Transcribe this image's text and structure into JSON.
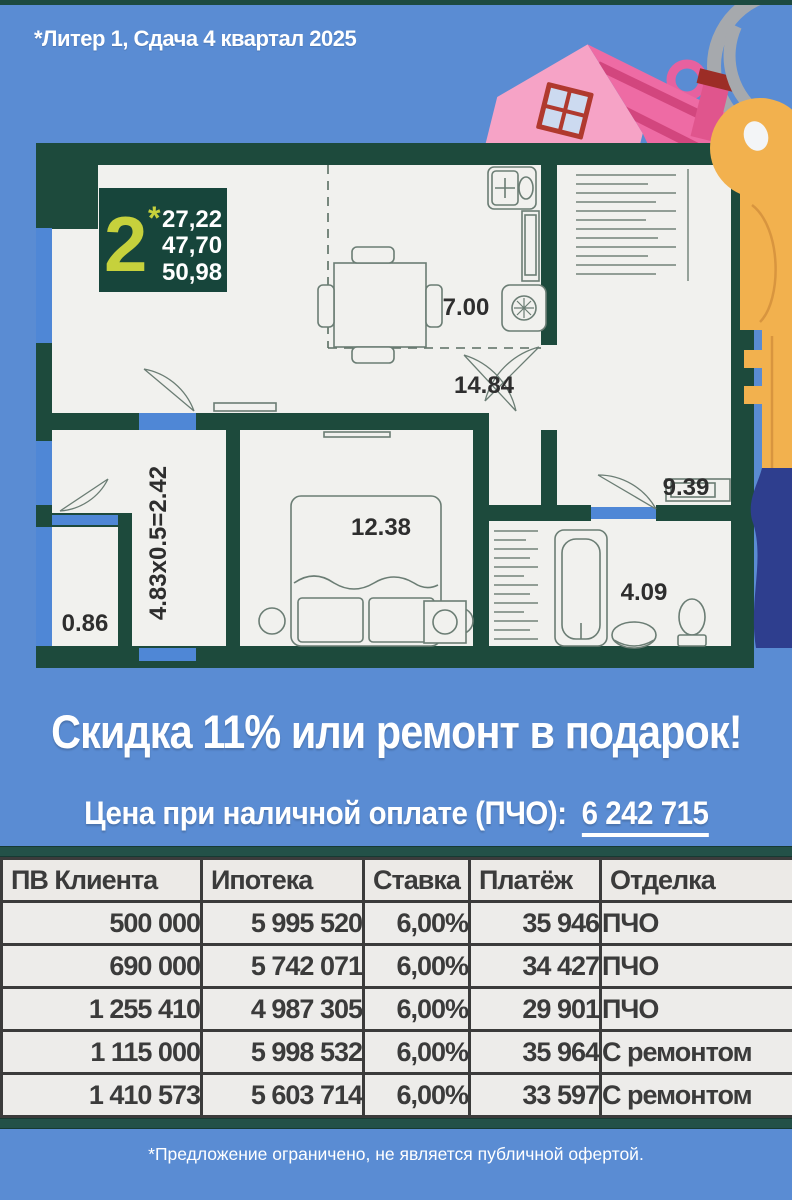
{
  "colors": {
    "background": "#5a8cd3",
    "wall": "#1d4a3c",
    "floor": "#f1f1ee",
    "window_blue": "#4f87d6",
    "accent_green": "#c6d13c",
    "table_bg": "#edecea",
    "table_border": "#3b3b3b",
    "table_teal_band": "#235148",
    "house_pink": "#ee6ba4",
    "key_orange": "#f2b14e"
  },
  "header": {
    "project_label": "*Литер 1, Сдача 4 квартал 2025"
  },
  "floorplan": {
    "badge": {
      "rooms_count": "2",
      "star": "*",
      "area_lines": [
        "27,22",
        "47,70",
        "50,98"
      ]
    },
    "labels": {
      "kitchen_area": "7.00",
      "living_area": "14.84",
      "bedroom_area": "12.38",
      "hall_area": "9.39",
      "bathroom_area": "4.09",
      "balcony_area": "0.86",
      "loggia_formula": "4.83x0.5=2.42"
    }
  },
  "promo": {
    "headline": "Скидка 11% или ремонт в подарок!",
    "price_label": "Цена при наличной оплате (ПЧО):",
    "price_value": "6 242 715"
  },
  "table": {
    "headers": [
      "ПВ Клиента",
      "Ипотека",
      "Ставка",
      "Платёж",
      "Отделка"
    ],
    "rows": [
      [
        "500 000",
        "5 995 520",
        "6,00%",
        "35 946",
        "ПЧО"
      ],
      [
        "690 000",
        "5 742 071",
        "6,00%",
        "34 427",
        "ПЧО"
      ],
      [
        "1 255 410",
        "4 987 305",
        "6,00%",
        "29 901",
        "ПЧО"
      ],
      [
        "1 115 000",
        "5 998 532",
        "6,00%",
        "35 964",
        "С ремонтом"
      ],
      [
        "1 410 573",
        "5 603 714",
        "6,00%",
        "33 597",
        "С ремонтом"
      ]
    ]
  },
  "footer": {
    "disclaimer": "*Предложение ограничено, не является публичной офертой."
  }
}
